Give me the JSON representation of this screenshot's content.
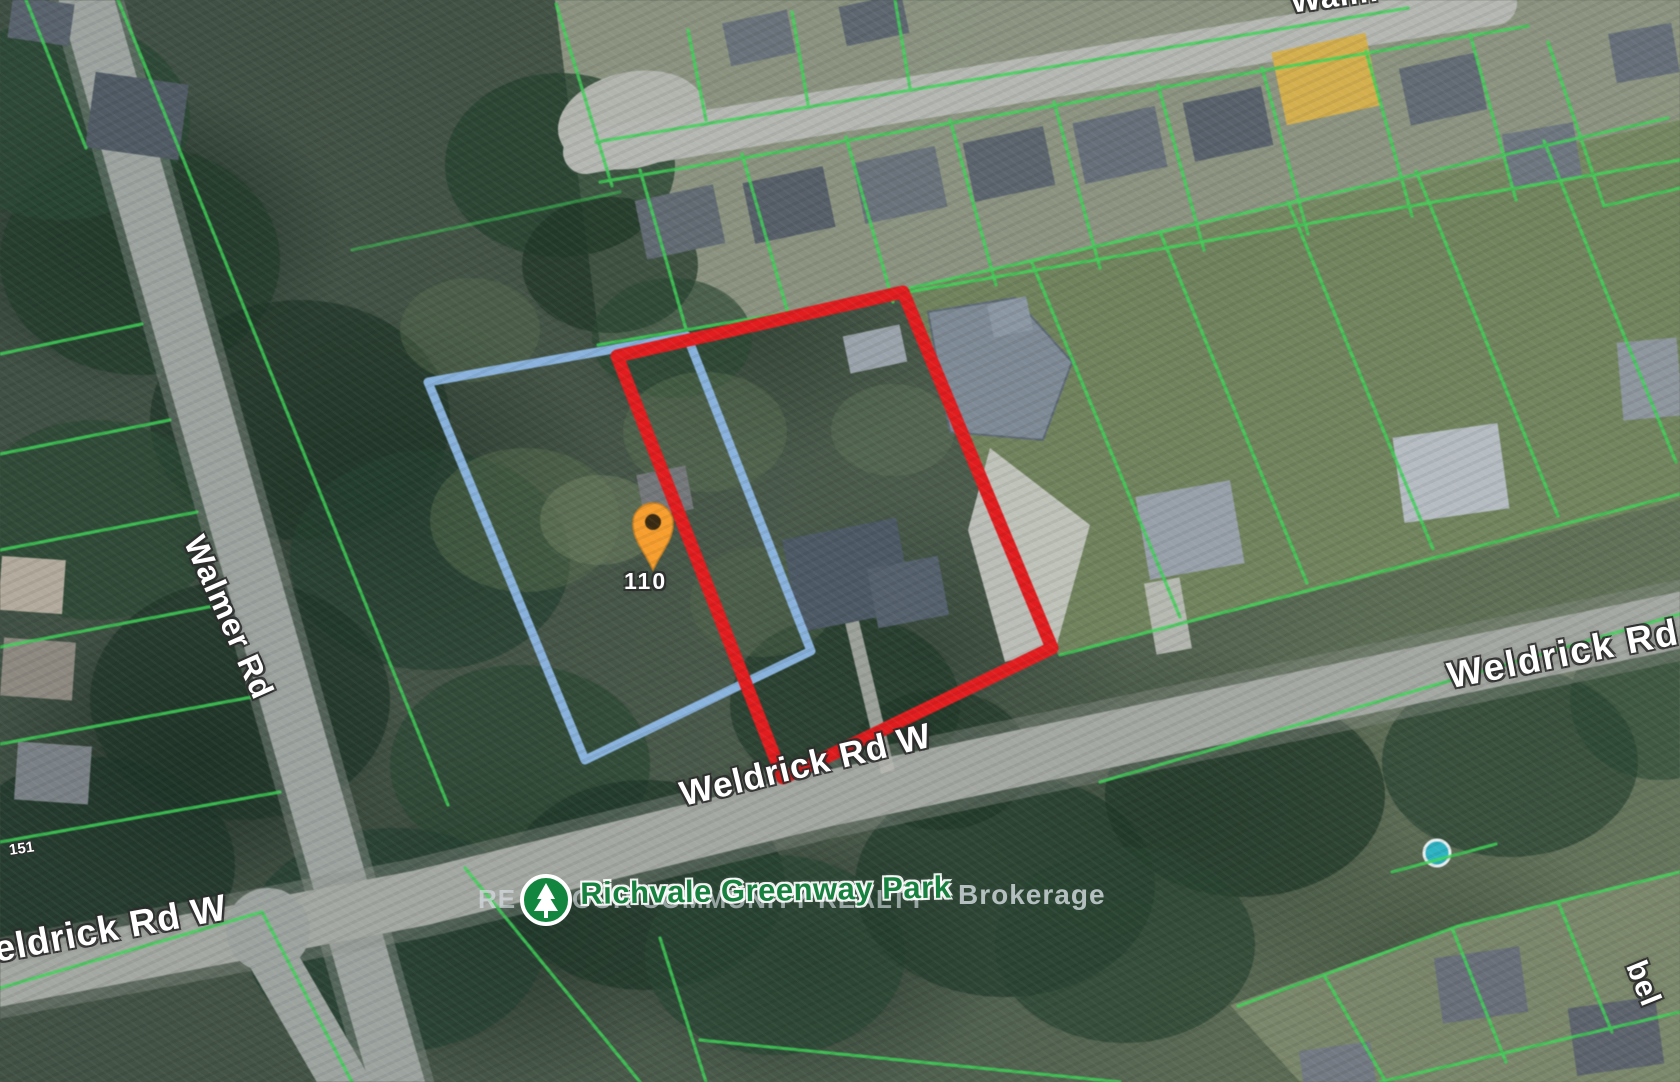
{
  "map": {
    "marker": {
      "label": "110"
    },
    "labels": {
      "walmer_rd": "Walmer Rd",
      "walmer_top_partial": "Walm",
      "weldrick_rd_w_left": "Weldrick Rd W",
      "weldrick_rd_w_center": "Weldrick Rd W",
      "weldrick_rd_right": "Weldrick Rd",
      "bottom_right_partial": "bel",
      "parcel_number_left": "151"
    },
    "park": {
      "name": "Richvale Greenway Park"
    },
    "watermark": {
      "prefix": "RE",
      "middle": "OUR COMMUNITY REALTY",
      "suffix": "Brokerage"
    },
    "colors": {
      "subject_boundary": "#e11d1f",
      "adjacent_boundary": "#8cb6e2",
      "parcel_lines": "#3ed457",
      "pin_fill": "#f79e2e",
      "pin_dot": "#3a2a12",
      "park_icon_green": "#12863f"
    }
  }
}
